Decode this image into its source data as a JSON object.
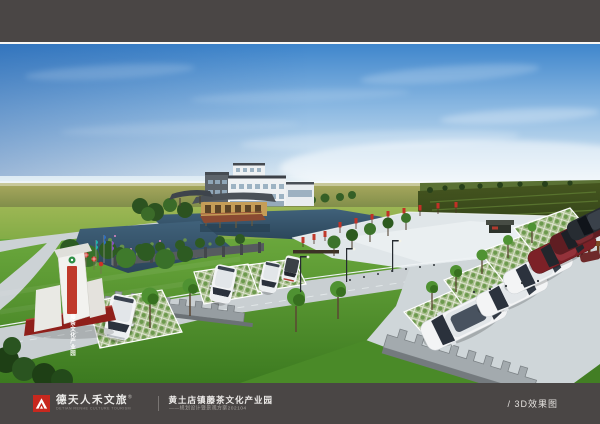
{
  "footer": {
    "brand": {
      "symbol_icon": "mountain-a-logo",
      "name_cn": "德天人禾文旅",
      "trademark": "®",
      "name_en": "DETIAN RENHE CULTURE TOURISM",
      "logo_bg": "#c7281e"
    },
    "project": {
      "title": "黄土店镇藤茶文化产业园",
      "subtitle": "——规划设计暨景观方案202104"
    },
    "page_label": "/ 3D效果图"
  },
  "scene": {
    "entrance_sign_text": "藤茶文化产业园",
    "palette": {
      "frame_bg": "#4a4645",
      "sky_top": "#3f86cc",
      "sky_mid": "#8cb9e2",
      "sky_horizon": "#e9f2f6",
      "far_field_light": "#a9a95f",
      "far_field_dark": "#7c8b47",
      "mid_field_light": "#9cb654",
      "mid_field_dark": "#74a63e",
      "near_grass_light": "#6aa73c",
      "near_grass_dark": "#3c7a20",
      "water_light": "#40617a",
      "water_dark": "#2b4559",
      "road": "#c9cfd2",
      "plaza": "#e0e6e9",
      "building_white": "#eef1f3",
      "roof_dark": "#3c4148",
      "wood": "#c59d57",
      "accent_red": "#c0392b",
      "car_white": "#f3f4f5",
      "car_maroon": "#7c2127"
    }
  }
}
